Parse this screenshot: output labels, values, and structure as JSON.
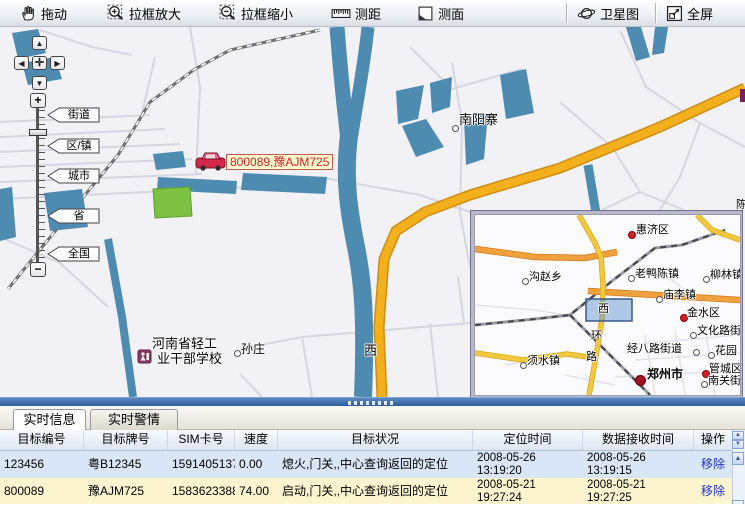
{
  "toolbar": {
    "buttons": [
      {
        "label": "拖动",
        "icon": "hand-icon"
      },
      {
        "label": "拉框放大",
        "icon": "zoom-in-box-icon"
      },
      {
        "label": "拉框缩小",
        "icon": "zoom-out-box-icon"
      },
      {
        "label": "测距",
        "icon": "ruler-icon"
      },
      {
        "label": "测面",
        "icon": "measure-area-icon"
      },
      {
        "label": "卫星图",
        "icon": "satellite-icon"
      },
      {
        "label": "全屏",
        "icon": "fullscreen-icon"
      }
    ]
  },
  "map": {
    "zoom_levels": [
      "街道",
      "区/镇",
      "城市",
      "省",
      "全国"
    ],
    "places": [
      {
        "name": "南阳寨"
      },
      {
        "name": "孙庄"
      },
      {
        "name": "河南省轻工"
      },
      {
        "name": "业干部学校"
      },
      {
        "name": "西"
      },
      {
        "name": "陈"
      }
    ],
    "vehicle": {
      "label": "800089,豫AJM725"
    },
    "colors": {
      "water": "#4e8bb0",
      "road": "#f3b01c",
      "green_area": "#7cc142"
    }
  },
  "inset": {
    "places": [
      {
        "name": "惠济区"
      },
      {
        "name": "沟赵乡"
      },
      {
        "name": "老鸭陈镇"
      },
      {
        "name": "柳林镇"
      },
      {
        "name": "庙李镇"
      },
      {
        "name": "金水区"
      },
      {
        "name": "文化路街"
      },
      {
        "name": "经八路街道"
      },
      {
        "name": "花园"
      },
      {
        "name": "须水镇"
      },
      {
        "name": "郑州市"
      },
      {
        "name": "管城区"
      },
      {
        "name": "南关街"
      }
    ],
    "road_chars": [
      "西",
      "环",
      "路"
    ]
  },
  "panel": {
    "tabs": [
      {
        "label": "实时信息"
      },
      {
        "label": "实时警情"
      }
    ],
    "table": {
      "headers": [
        "目标编号",
        "目标牌号",
        "SIM卡号",
        "速度",
        "目标状况",
        "定位时间",
        "数据接收时间",
        "操作"
      ],
      "rows": [
        {
          "id": "123456",
          "plate": "粤B12345",
          "sim": "15914051378",
          "speed": "0.00",
          "status": "熄火,门关,,中心查询返回的定位",
          "loc_date": "2008-05-26",
          "loc_time": "13:19:20",
          "recv_date": "2008-05-26",
          "recv_time": "13:19:15",
          "action": "移除"
        },
        {
          "id": "800089",
          "plate": "豫AJM725",
          "sim": "15836233884",
          "speed": "74.00",
          "status": "启动,门关,,中心查询返回的定位",
          "loc_date": "2008-05-21",
          "loc_time": "19:27:24",
          "recv_date": "2008-05-21",
          "recv_time": "19:27:25",
          "action": "移除"
        }
      ]
    }
  }
}
